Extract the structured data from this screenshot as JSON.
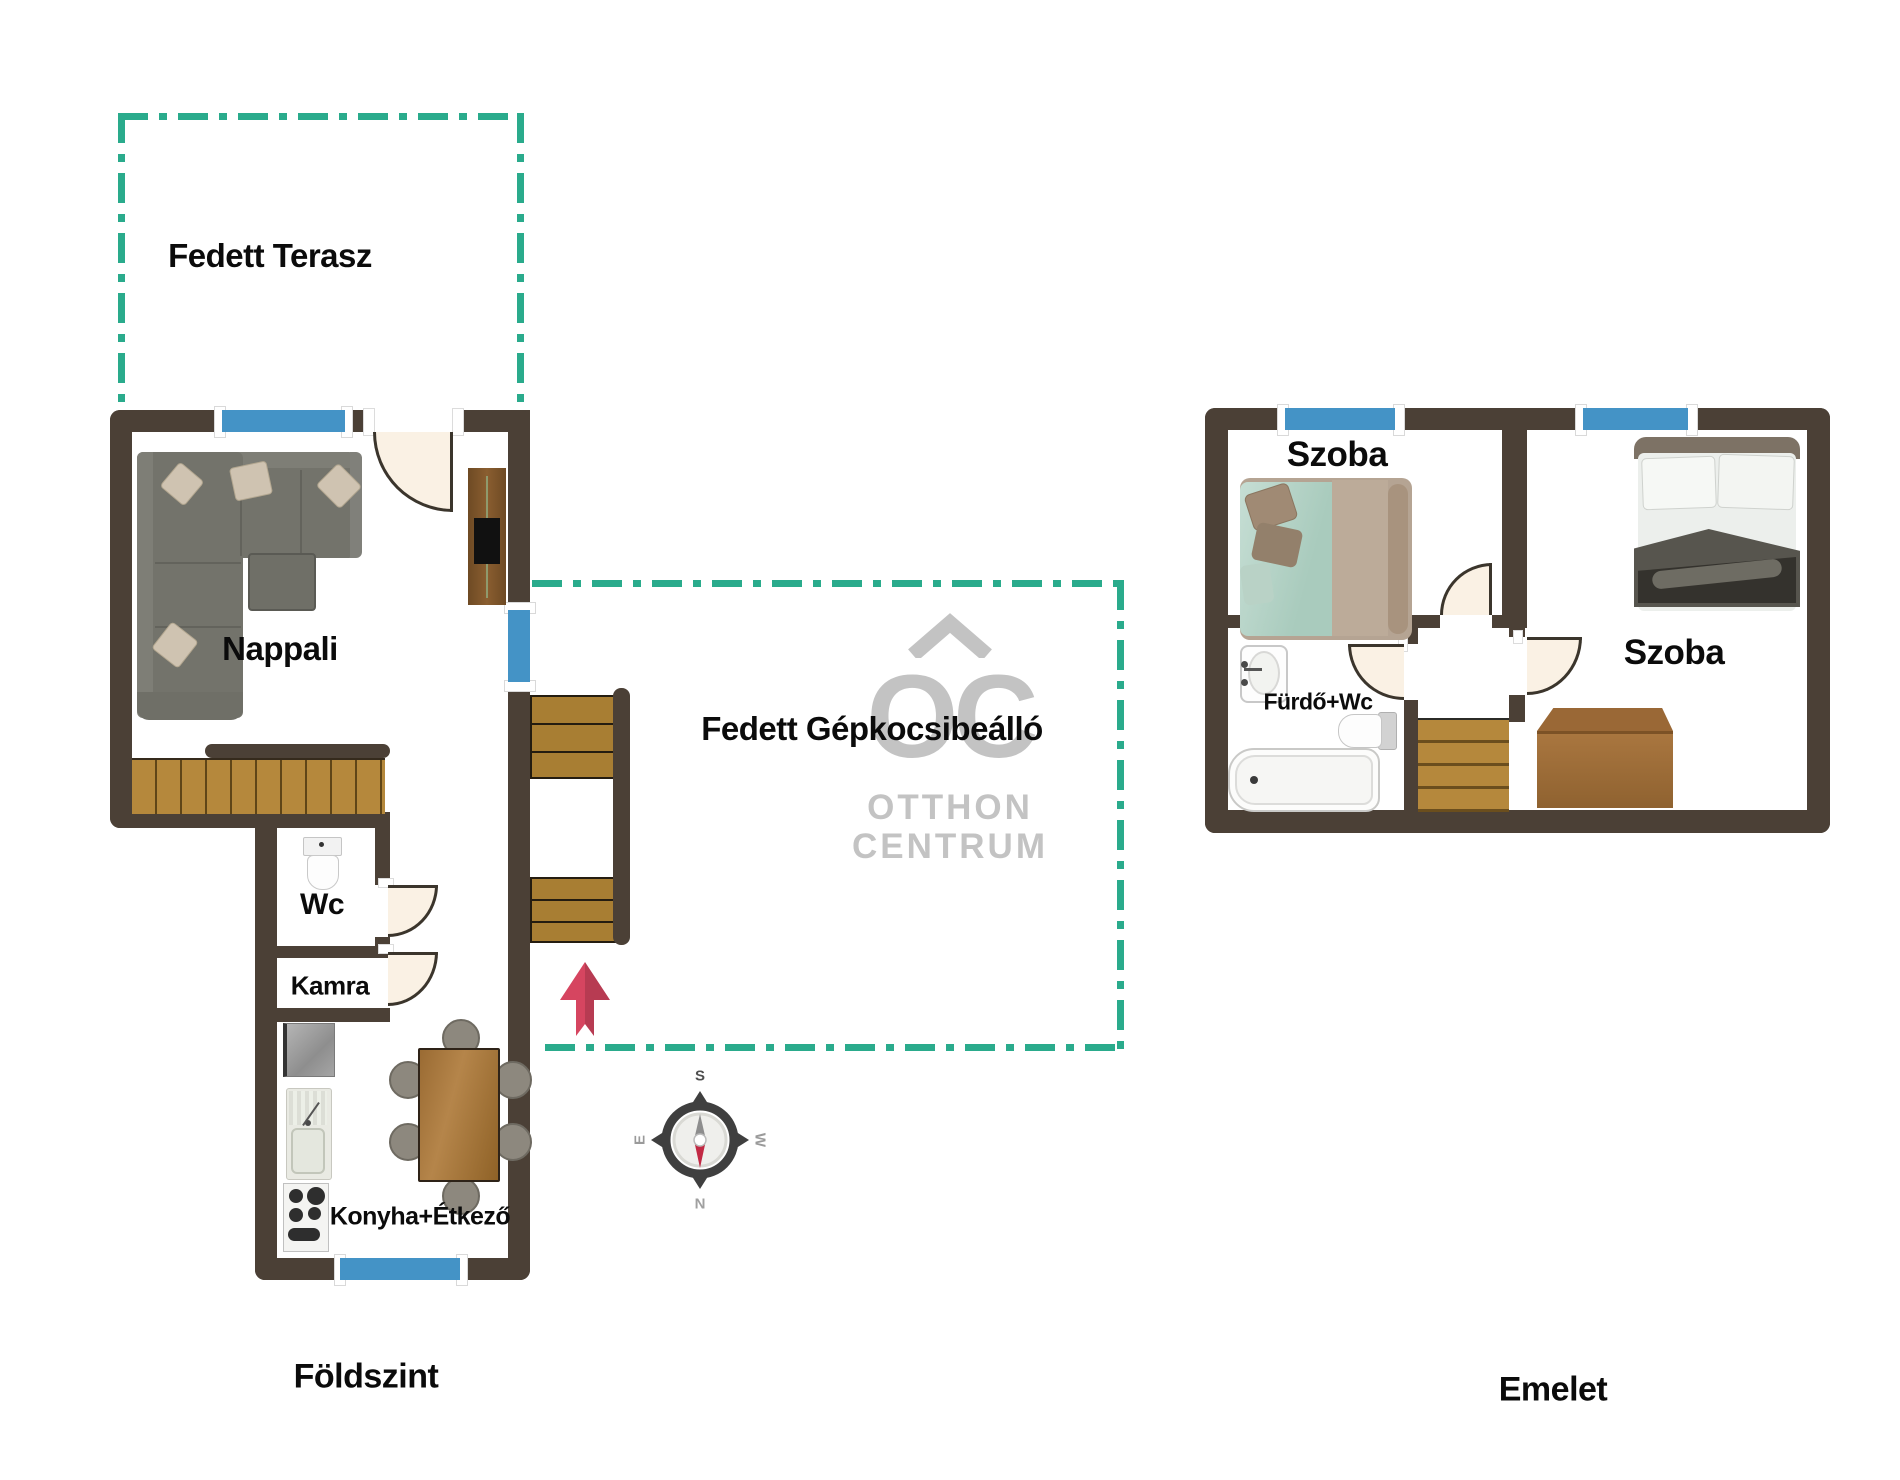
{
  "plan": {
    "ground_floor": {
      "floor_label": "Földszint",
      "rooms": {
        "terrace_label": "Fedett Terasz",
        "living_label": "Nappali",
        "wc_label": "Wc",
        "pantry_label": "Kamra",
        "kitchen_label": "Konyha+Étkező",
        "carport_label": "Fedett Gépkocsibeálló"
      }
    },
    "upper_floor": {
      "floor_label": "Emelet",
      "rooms": {
        "bedroom1_label": "Szoba",
        "bedroom2_label": "Szoba",
        "bathroom_label": "Fürdő+Wc"
      }
    },
    "compass": {
      "north": "N",
      "south": "S",
      "east": "E",
      "west": "W"
    },
    "logo": {
      "monogram": "OC",
      "line1": "OTTHON",
      "line2": "CENTRUM"
    },
    "colors": {
      "wall": "#4b4036",
      "outline_teal": "#2aab8c",
      "window_blue": "#4493c6",
      "wood": "#b5883c",
      "wood_dark": "#5f4517",
      "door_fill": "#faf1e4",
      "door_line": "#3b352c",
      "arrow_red": "#d64560",
      "logo_gray": "#c3c3c3",
      "sofa_gray": "#73736b",
      "text_black": "#0b0b0b"
    }
  }
}
